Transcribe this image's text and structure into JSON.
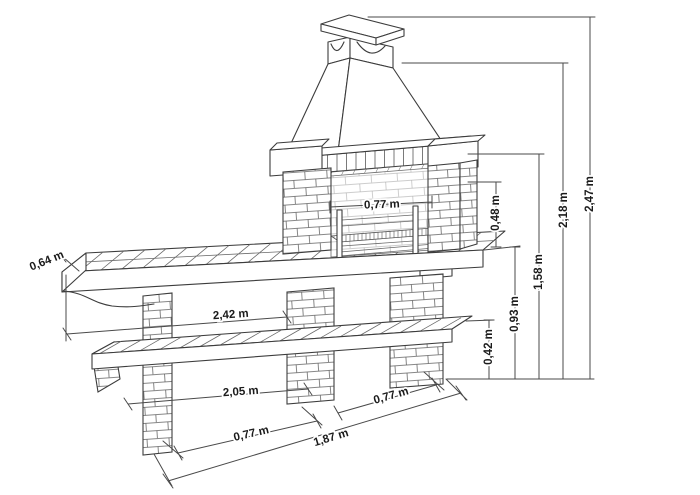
{
  "diagram": {
    "subject": "brick-barbecue-dimensional-drawing",
    "unit": "m",
    "colors": {
      "background": "#ffffff",
      "line": "#3c3c3c",
      "dimension_line": "#4a4a4a",
      "label": "#1b1b1b"
    },
    "dimensions": {
      "counter_depth": "0,64 m",
      "firebox_width": "0,77 m",
      "firebox_opening_height": "0,48 m",
      "counter_length": "2,42 m",
      "counter_height": "0,93 m",
      "lower_shelf_length": "2,05 m",
      "lower_shelf_height": "0,42 m",
      "pier_spacing": "0,77 m",
      "side_depth": "0,77 m",
      "base_length": "1,87 m",
      "mantel_height": "1,58 m",
      "hood_height": "2,18 m",
      "total_height": "2,47 m"
    }
  }
}
